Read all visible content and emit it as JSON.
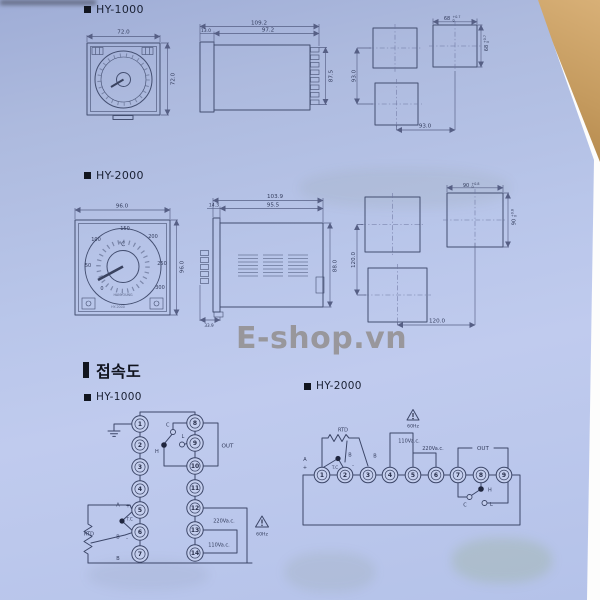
{
  "photo": {
    "watermark": "E-shop.vn",
    "watermark_color": "#8b8170"
  },
  "sections": {
    "dim_hy1000": "HY-1000",
    "dim_hy2000": "HY-2000",
    "connection_title": "접속도",
    "conn_hy1000": "HY-1000",
    "conn_hy2000": "HY-2000"
  },
  "hy1000": {
    "front": {
      "w": "72.0",
      "h": "72.0"
    },
    "side": {
      "total": "109.2",
      "body": "97.2",
      "bezel": "13.0",
      "h": "87.5"
    },
    "cutout": {
      "w": "68",
      "h": "68",
      "tol_plus": "+0.7",
      "tol_zero": "0",
      "pitch_v": "93.0",
      "pitch_h": "93.0"
    }
  },
  "hy2000": {
    "front": {
      "w": "96.0",
      "h": "96.0",
      "unit": "℃",
      "scale": [
        "0",
        "50",
        "100",
        "150",
        "200",
        "250",
        "300"
      ],
      "brand": "HANYOUNG",
      "model": "HY-2000"
    },
    "side": {
      "total": "103.9",
      "body": "95.5",
      "bezel": "14.3",
      "h": "88.0",
      "bottom": "33.9"
    },
    "cutout": {
      "w": "90",
      "h": "90",
      "tol_plus": "+0.8",
      "tol_zero": "0",
      "pitch_v": "120.0",
      "pitch_h": "120.0"
    }
  },
  "wiring1": {
    "t": [
      "1",
      "2",
      "3",
      "4",
      "5",
      "6",
      "7",
      "8",
      "9",
      "10",
      "11",
      "12",
      "13",
      "14"
    ],
    "out": "OUT",
    "c": "C",
    "h": "H",
    "l": "L",
    "a": "A",
    "plus": "+",
    "b1": "B",
    "minus": "-",
    "tc": "T.C",
    "rtd": "RTD",
    "b2": "B",
    "v220": "220Va.c.",
    "v110": "110Va.c.",
    "hz": "60Hz"
  },
  "wiring2": {
    "t": [
      "1",
      "2",
      "3",
      "4",
      "5",
      "6",
      "7",
      "8",
      "9"
    ],
    "rtd": "RTD",
    "a": "A",
    "plus": "+",
    "b1": "B",
    "minus": "-",
    "b2": "B",
    "tc": "T.C",
    "hz": "60Hz",
    "v110": "110Va.c.",
    "v220": "220Va.c.",
    "out": "OUT",
    "h": "H",
    "c": "C",
    "l": "L"
  }
}
